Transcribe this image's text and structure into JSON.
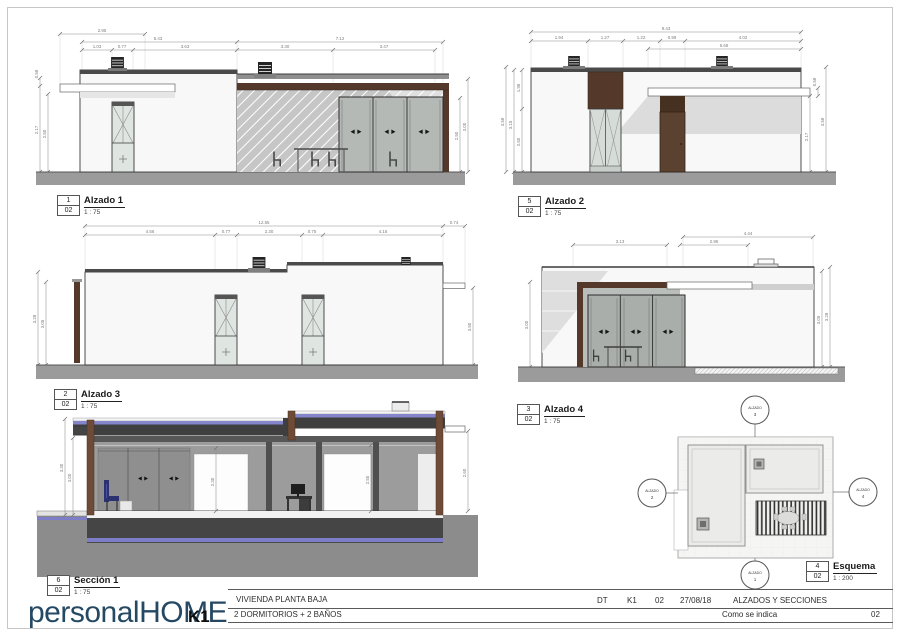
{
  "views": {
    "alzado1": {
      "num": "1",
      "sheet": "02",
      "title": "Alzado 1",
      "scale": "1 : 75",
      "dims": [
        "2.95",
        "5.43",
        "7.12",
        "1.03",
        "0.77",
        "3.63",
        "3.30",
        "3.47"
      ],
      "vdims": [
        "0.58",
        "2.17",
        "2.50",
        "2.50",
        "3.00"
      ]
    },
    "alzado2": {
      "num": "5",
      "sheet": "02",
      "title": "Alzado 2",
      "scale": "1 : 75",
      "dims": [
        "9.43",
        "1.94",
        "1.27",
        "1.22",
        "0.99",
        "4.02",
        "5.68"
      ],
      "vdims": [
        "3.58",
        "3.15",
        "1.98",
        "2.50",
        "2.17",
        "0.58",
        "3.58"
      ]
    },
    "alzado3": {
      "num": "2",
      "sheet": "02",
      "title": "Alzado 3",
      "scale": "1 : 75",
      "dims": [
        "12.55",
        "0.74",
        "4.56",
        "0.77",
        "2.30",
        "0.75",
        "4.16"
      ],
      "vdims": [
        "3.28",
        "3.05",
        "3.50"
      ]
    },
    "alzado4": {
      "num": "3",
      "sheet": "02",
      "title": "Alzado 4",
      "scale": "1 : 75",
      "dims": [
        "4.44",
        "3.13",
        "2.95"
      ],
      "vdims": [
        "3.00",
        "3.05",
        "3.28"
      ]
    },
    "seccion1": {
      "num": "6",
      "sheet": "02",
      "title": "Sección 1",
      "scale": "1 : 75",
      "vdims": [
        "3.30",
        "3.00",
        "2.30",
        "2.50",
        "2.60"
      ]
    },
    "esquema": {
      "num": "4",
      "sheet": "02",
      "title": "Esquema",
      "scale": "1 : 200",
      "markers": [
        {
          "label": "ALZADO",
          "num": "3"
        },
        {
          "label": "ALZADO",
          "num": "2"
        },
        {
          "label": "ALZADO",
          "num": "4"
        },
        {
          "label": "ALZADO",
          "num": "1"
        }
      ]
    }
  },
  "titleblock": {
    "logo": "personalHOME",
    "logo_suffix": "K1",
    "project": "VIVIENDA PLANTA BAJA",
    "program": "2 DORMITORIOS + 2 BAÑOS",
    "code": "DT",
    "model": "K1",
    "revision": "02",
    "date": "27/08/18",
    "sheet_title": "ALZADOS Y SECCIONES",
    "scale_text": "Como se indica",
    "sheet_number": "02"
  },
  "colors": {
    "brand_navy": "#254963",
    "wood_brown": "#54392b",
    "ground_gray": "#9b9b9b",
    "glass_gray": "#aeb3b0",
    "slab_dark": "#3f3f3f",
    "insulation_blue": "#7d7dc8"
  }
}
